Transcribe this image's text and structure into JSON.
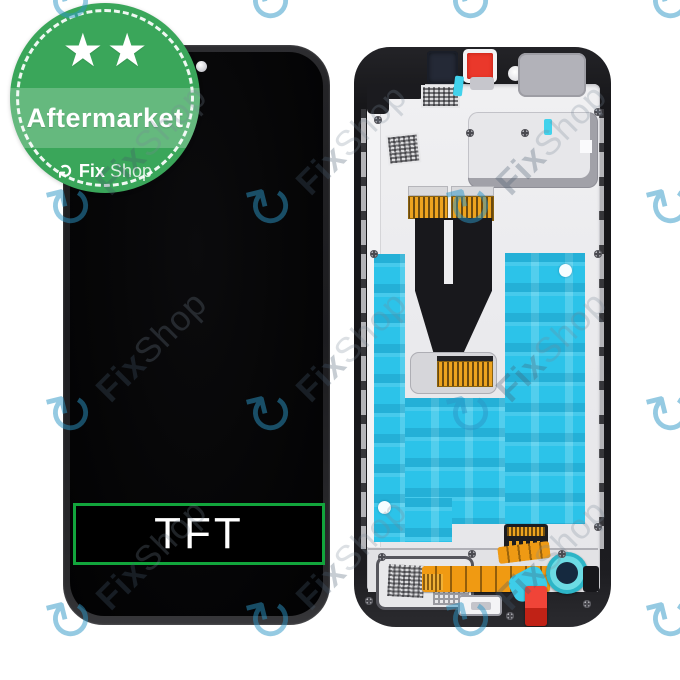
{
  "product_image": {
    "badge": {
      "label": "Aftermarket",
      "star_count": 2,
      "star_char": "★",
      "refresh_char": "↻",
      "brand_bold": "Fix",
      "brand_light": "Shop",
      "green": "#3aa65a"
    },
    "front_panel": {
      "technology_label": "TFT",
      "label_border_color": "#12a53c",
      "label_text_color": "#ffffff"
    },
    "watermark": {
      "brand_bold": "Fix",
      "brand_light": "Shop",
      "icon_char": "↻",
      "icon_color": "rgba(44,150,198,0.5)"
    },
    "colors": {
      "adhesive_cyan": "#2cc3e9",
      "flex_orange": "#ef9a14",
      "foam_red": "#ea382b",
      "frame_black": "#17171a",
      "plate_gray": "#ececee"
    }
  }
}
